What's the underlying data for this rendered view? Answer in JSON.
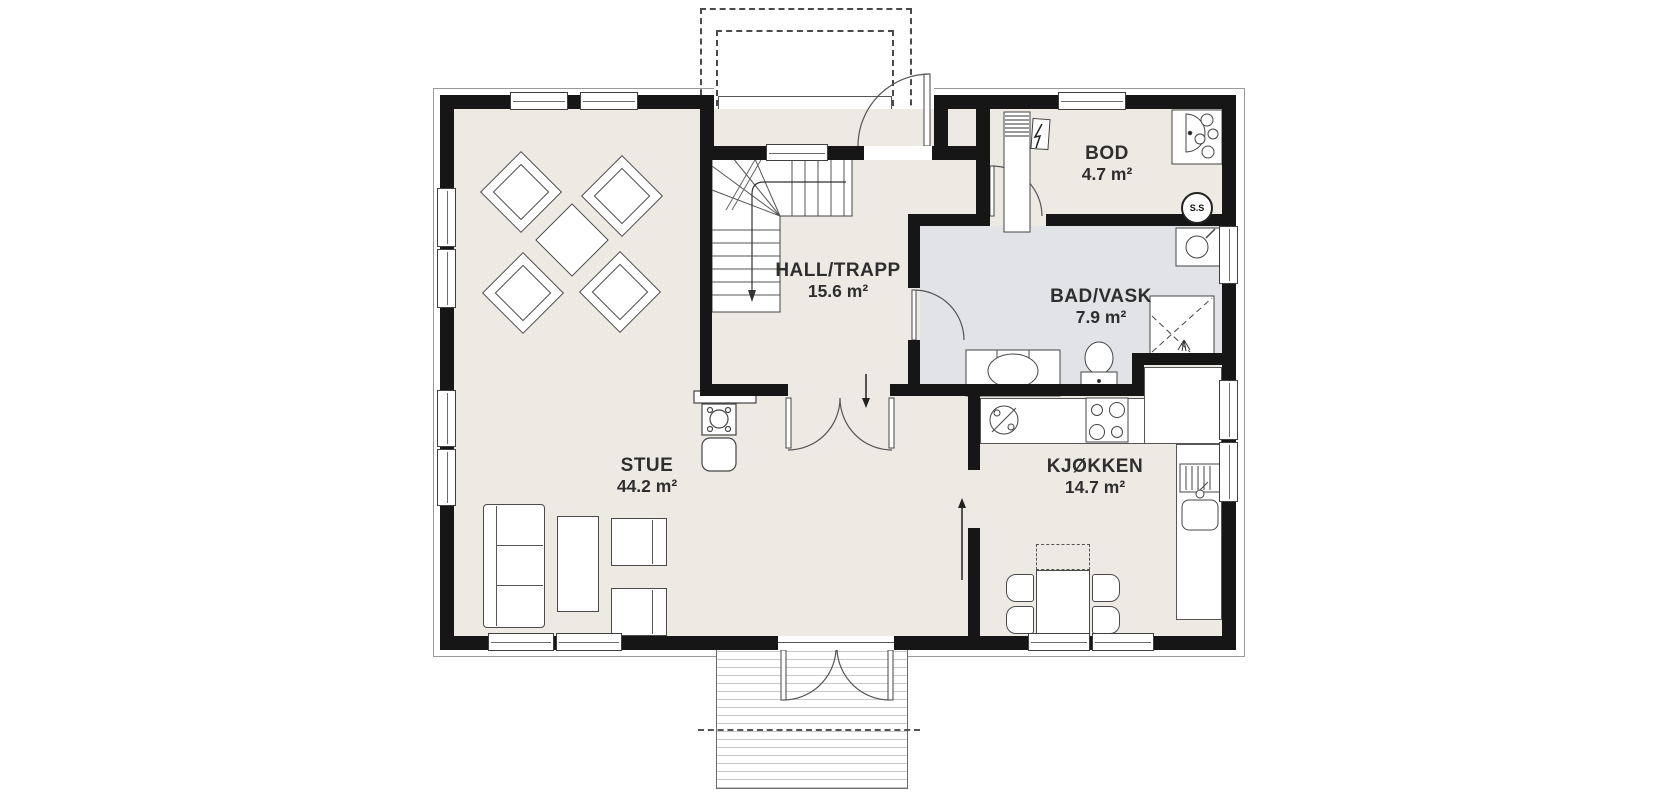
{
  "plan": {
    "rooms": [
      {
        "id": "stue",
        "label": "STUE",
        "area": "44.2 m²"
      },
      {
        "id": "hall",
        "label": "HALL/TRAPP",
        "area": "15.6 m²"
      },
      {
        "id": "bod",
        "label": "BOD",
        "area": "4.7 m²"
      },
      {
        "id": "bad",
        "label": "BAD/VASK",
        "area": "7.9 m²"
      },
      {
        "id": "kjokken",
        "label": "KJØKKEN",
        "area": "14.7 m²"
      }
    ],
    "badges": {
      "ss": "S.S"
    },
    "fixtures": [
      "stairs",
      "entry-door",
      "terrace-double-door",
      "interior-double-door",
      "bathroom-door",
      "storage-door",
      "toilet",
      "vanity-sink",
      "shower",
      "laundry-sink",
      "water-heater",
      "ventilation-duct",
      "electrical-panel",
      "fireplace",
      "dishwasher",
      "cooktop",
      "kitchen-sink",
      "sofa",
      "coffee-table",
      "armchair",
      "dining-table",
      "dining-chair",
      "kitchen-table",
      "terrace-deck",
      "entry-porch",
      "down-arrow",
      "up-arrow"
    ],
    "colors": {
      "wall": "#161616",
      "floor": "#ECEAE3",
      "floor_bathroom": "#E2E3E6",
      "outline": "#3c3c3c",
      "background": "#ffffff"
    }
  }
}
